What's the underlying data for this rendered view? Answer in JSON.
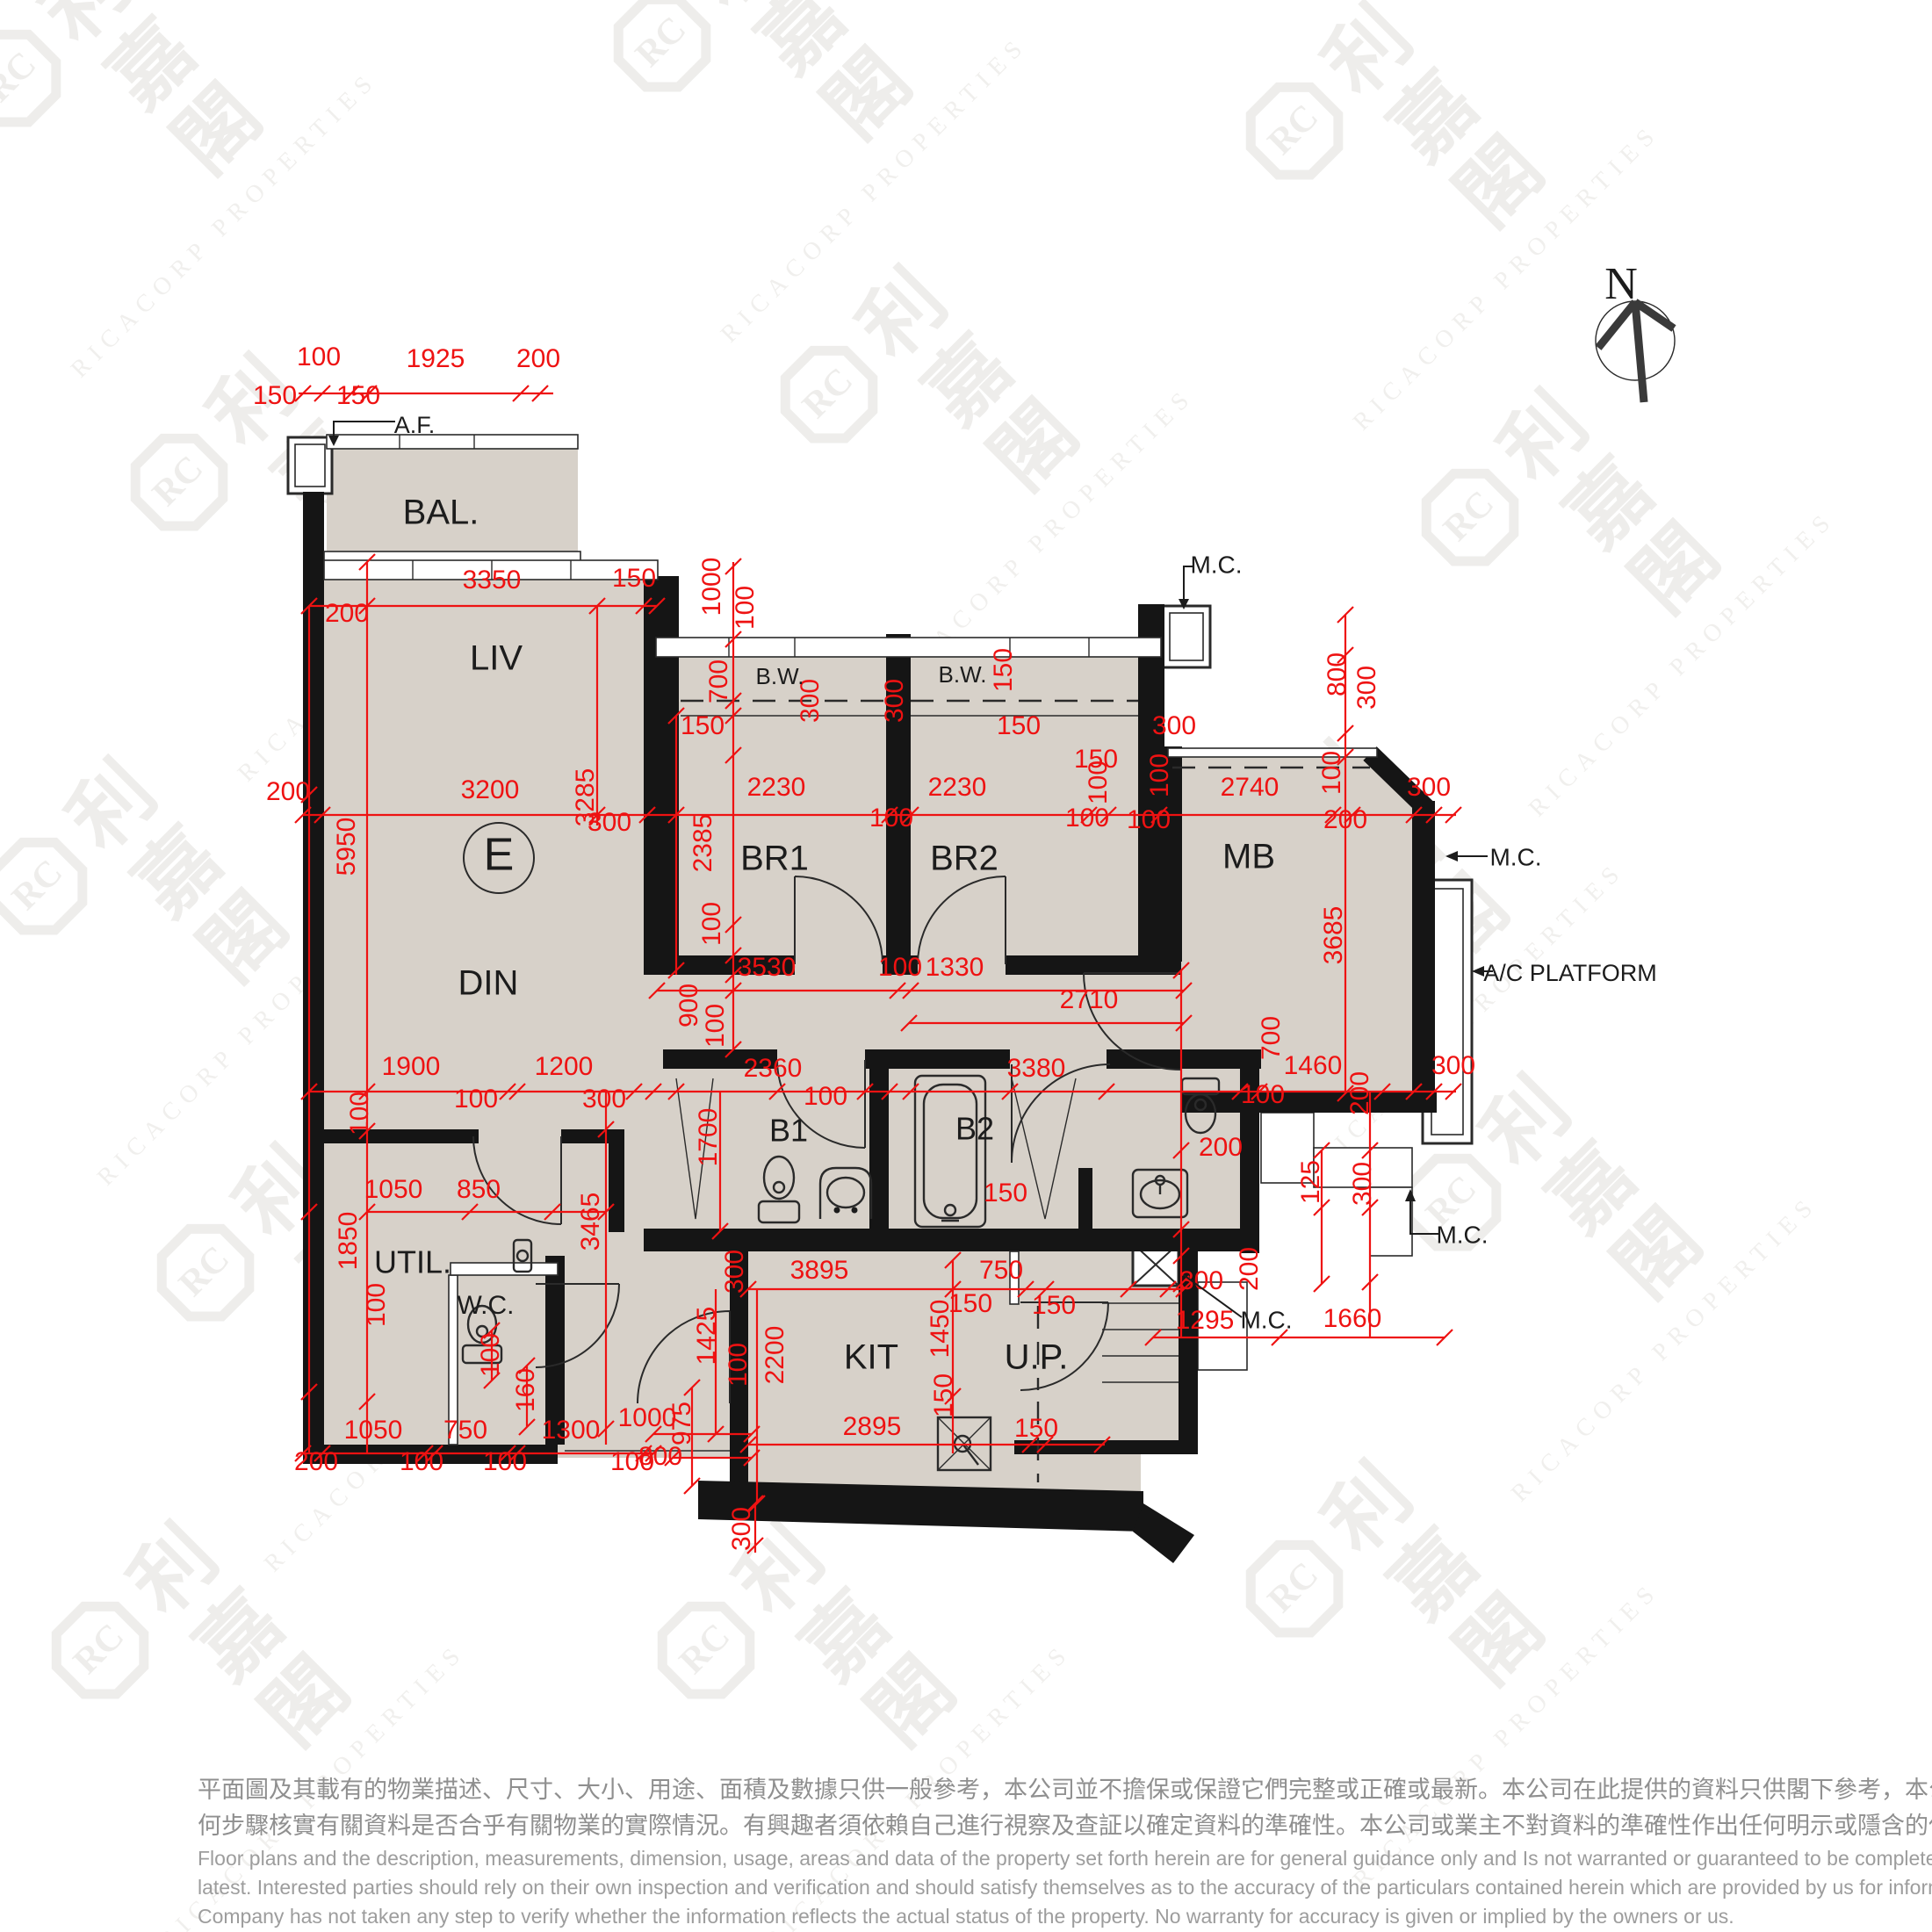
{
  "colors": {
    "floor": "#d7d1c9",
    "wall": "#151515",
    "dimension_red": "#ee1212",
    "watermark_gray": "#dedcd8",
    "disclaimer_gray": "#8f8f8f"
  },
  "north": {
    "label": "N"
  },
  "watermark": {
    "cjk": "利嘉閣",
    "latin": "RICACORP PROPERTIES",
    "logo": "RC",
    "tiles": [
      [
        140,
        140
      ],
      [
        880,
        100
      ],
      [
        1600,
        200
      ],
      [
        330,
        600
      ],
      [
        1070,
        500
      ],
      [
        1800,
        640
      ],
      [
        170,
        1060
      ],
      [
        900,
        960
      ],
      [
        1560,
        1040
      ],
      [
        360,
        1500
      ],
      [
        1080,
        1440
      ],
      [
        1780,
        1420
      ],
      [
        240,
        1930
      ],
      [
        930,
        1930
      ],
      [
        1600,
        1860
      ]
    ]
  },
  "rooms": [
    [
      "BAL.",
      502,
      586,
      40
    ],
    [
      "LIV",
      565,
      752,
      40
    ],
    [
      "DIN",
      556,
      1122,
      40
    ],
    [
      "E",
      568,
      977,
      52
    ],
    [
      "BR1",
      882,
      980,
      40
    ],
    [
      "BR2",
      1098,
      980,
      40
    ],
    [
      "MB",
      1422,
      978,
      40
    ],
    [
      "B1",
      898,
      1290,
      36
    ],
    [
      "B2",
      1110,
      1288,
      36
    ],
    [
      "UTIL.",
      470,
      1440,
      36
    ],
    [
      "W.C.",
      553,
      1488,
      30
    ],
    [
      "KIT",
      992,
      1548,
      40
    ],
    [
      "U.P.",
      1180,
      1548,
      40
    ]
  ],
  "annotations": [
    [
      "A.F.",
      472,
      486,
      27
    ],
    [
      "B.W.",
      888,
      772,
      26
    ],
    [
      "B.W.",
      1096,
      770,
      26
    ],
    [
      "M.C.",
      1385,
      645,
      28
    ],
    [
      "M.C.",
      1726,
      978,
      28
    ],
    [
      "M.C.",
      1665,
      1408,
      28
    ],
    [
      "M.C.",
      1442,
      1505,
      28
    ],
    [
      "A/C PLATFORM",
      1788,
      1110,
      27
    ]
  ],
  "dims": [
    [
      "100",
      363,
      408
    ],
    [
      "1925",
      496,
      410
    ],
    [
      "200",
      613,
      410
    ],
    [
      "150",
      313,
      452
    ],
    [
      "150",
      408,
      452
    ],
    [
      "3350",
      560,
      662
    ],
    [
      "150",
      722,
      660
    ],
    [
      "200",
      395,
      700
    ],
    [
      "1000",
      812,
      668,
      1
    ],
    [
      "100",
      850,
      692,
      1
    ],
    [
      "200",
      328,
      903
    ],
    [
      "3200",
      558,
      901
    ],
    [
      "3285",
      668,
      908,
      1
    ],
    [
      "300",
      694,
      938
    ],
    [
      "5950",
      396,
      964,
      1
    ],
    [
      "700",
      820,
      776,
      1
    ],
    [
      "300",
      924,
      798,
      1
    ],
    [
      "300",
      1020,
      798,
      1
    ],
    [
      "150",
      800,
      828
    ],
    [
      "150",
      1144,
      763,
      1
    ],
    [
      "150",
      1160,
      828
    ],
    [
      "150",
      1248,
      866
    ],
    [
      "300",
      1337,
      828
    ],
    [
      "2230",
      884,
      898
    ],
    [
      "2230",
      1090,
      898
    ],
    [
      "100",
      1015,
      933
    ],
    [
      "100",
      1238,
      933
    ],
    [
      "2385",
      802,
      960,
      1
    ],
    [
      "100",
      1252,
      891,
      1
    ],
    [
      "800",
      1524,
      768,
      1
    ],
    [
      "300",
      1558,
      783,
      1
    ],
    [
      "2740",
      1423,
      898
    ],
    [
      "100",
      1322,
      883,
      1
    ],
    [
      "100",
      1518,
      880,
      1
    ],
    [
      "100",
      1308,
      935
    ],
    [
      "200",
      1532,
      935
    ],
    [
      "300",
      1627,
      898
    ],
    [
      "3685",
      1520,
      1065,
      1
    ],
    [
      "100",
      812,
      1052,
      1
    ],
    [
      "3530",
      873,
      1103
    ],
    [
      "100",
      1025,
      1103
    ],
    [
      "1330",
      1087,
      1103
    ],
    [
      "900",
      786,
      1145,
      1
    ],
    [
      "100",
      816,
      1168,
      1
    ],
    [
      "2710",
      1240,
      1140
    ],
    [
      "1900",
      468,
      1216
    ],
    [
      "100",
      542,
      1253
    ],
    [
      "1200",
      642,
      1216
    ],
    [
      "300",
      688,
      1253
    ],
    [
      "100",
      411,
      1268,
      1
    ],
    [
      "2360",
      880,
      1218
    ],
    [
      "100",
      940,
      1250
    ],
    [
      "3380",
      1180,
      1218
    ],
    [
      "1700",
      808,
      1295,
      1
    ],
    [
      "150",
      1145,
      1360
    ],
    [
      "1460",
      1495,
      1215
    ],
    [
      "100",
      1438,
      1248
    ],
    [
      "300",
      1655,
      1215
    ],
    [
      "200",
      1550,
      1245,
      1
    ],
    [
      "700",
      1449,
      1182,
      1
    ],
    [
      "200",
      1390,
      1308
    ],
    [
      "125",
      1494,
      1346,
      1
    ],
    [
      "300",
      1553,
      1348,
      1
    ],
    [
      "200",
      1424,
      1445,
      1
    ],
    [
      "300",
      1368,
      1460
    ],
    [
      "1295",
      1372,
      1505
    ],
    [
      "1660",
      1540,
      1503
    ],
    [
      "1050",
      448,
      1356
    ],
    [
      "850",
      545,
      1356
    ],
    [
      "1850",
      398,
      1413,
      1
    ],
    [
      "100",
      430,
      1486,
      1
    ],
    [
      "3465",
      674,
      1391,
      1
    ],
    [
      "100",
      560,
      1543,
      1
    ],
    [
      "160",
      600,
      1583,
      1
    ],
    [
      "3895",
      933,
      1448
    ],
    [
      "300",
      838,
      1448,
      1
    ],
    [
      "750",
      1140,
      1448
    ],
    [
      "150",
      1105,
      1486
    ],
    [
      "150",
      1200,
      1488
    ],
    [
      "1450",
      1072,
      1513,
      1
    ],
    [
      "1425",
      806,
      1521,
      1
    ],
    [
      "100",
      842,
      1554,
      1
    ],
    [
      "2200",
      884,
      1543,
      1
    ],
    [
      "150",
      1076,
      1589,
      1
    ],
    [
      "2895",
      993,
      1626
    ],
    [
      "150",
      1180,
      1628
    ],
    [
      "975",
      778,
      1621,
      1
    ],
    [
      "300",
      846,
      1741,
      1
    ],
    [
      "200",
      360,
      1666
    ],
    [
      "1050",
      425,
      1630
    ],
    [
      "100",
      480,
      1666
    ],
    [
      "750",
      530,
      1630
    ],
    [
      "100",
      575,
      1666
    ],
    [
      "1300",
      650,
      1630
    ],
    [
      "100",
      720,
      1666
    ],
    [
      "1000",
      737,
      1616
    ],
    [
      "800",
      752,
      1660
    ]
  ],
  "layout": {
    "ticks": [
      [
        345,
        448
      ],
      [
        367,
        448
      ],
      [
        400,
        448
      ],
      [
        420,
        448
      ],
      [
        593,
        448
      ],
      [
        615,
        448
      ],
      [
        352,
        690
      ],
      [
        418,
        690
      ],
      [
        680,
        690
      ],
      [
        733,
        690
      ],
      [
        748,
        690
      ],
      [
        345,
        928
      ],
      [
        367,
        928
      ],
      [
        680,
        928
      ],
      [
        737,
        928
      ],
      [
        770,
        928
      ],
      [
        1013,
        928
      ],
      [
        1037,
        928
      ],
      [
        1240,
        928
      ],
      [
        1262,
        928
      ],
      [
        1320,
        928
      ],
      [
        1518,
        928
      ],
      [
        1540,
        928
      ],
      [
        1610,
        928
      ],
      [
        1633,
        928
      ],
      [
        1655,
        928
      ],
      [
        748,
        1128
      ],
      [
        835,
        1128
      ],
      [
        1022,
        1128
      ],
      [
        1037,
        1128
      ],
      [
        1348,
        1128
      ],
      [
        1035,
        1165
      ],
      [
        1348,
        1165
      ],
      [
        352,
        1243
      ],
      [
        418,
        1243
      ],
      [
        578,
        1243
      ],
      [
        589,
        1243
      ],
      [
        722,
        1243
      ],
      [
        744,
        1243
      ],
      [
        770,
        1243
      ],
      [
        885,
        1243
      ],
      [
        985,
        1243
      ],
      [
        1013,
        1243
      ],
      [
        1037,
        1243
      ],
      [
        1150,
        1243
      ],
      [
        1260,
        1243
      ],
      [
        1412,
        1243
      ],
      [
        1434,
        1243
      ],
      [
        1574,
        1243
      ],
      [
        1610,
        1243
      ],
      [
        1633,
        1243
      ],
      [
        1655,
        1243
      ],
      [
        418,
        1380
      ],
      [
        535,
        1380
      ],
      [
        629,
        1380
      ],
      [
        690,
        1380
      ],
      [
        852,
        1468
      ],
      [
        1085,
        1468
      ],
      [
        1168,
        1468
      ],
      [
        1191,
        1468
      ],
      [
        1285,
        1468
      ],
      [
        1330,
        1468
      ],
      [
        1348,
        1468
      ],
      [
        1313,
        1523
      ],
      [
        1457,
        1523
      ],
      [
        1645,
        1523
      ],
      [
        852,
        1645
      ],
      [
        1173,
        1645
      ],
      [
        1190,
        1645
      ],
      [
        1255,
        1645
      ],
      [
        345,
        1655
      ],
      [
        367,
        1655
      ],
      [
        484,
        1655
      ],
      [
        495,
        1655
      ],
      [
        578,
        1655
      ],
      [
        589,
        1655
      ],
      [
        733,
        1655
      ],
      [
        744,
        1655
      ],
      [
        744,
        1633
      ],
      [
        856,
        1633
      ],
      [
        766,
        1660
      ],
      [
        856,
        1660
      ],
      [
        352,
        905
      ],
      [
        352,
        1380
      ],
      [
        352,
        1585
      ],
      [
        418,
        640
      ],
      [
        418,
        1288
      ],
      [
        418,
        1596
      ],
      [
        770,
        815
      ],
      [
        770,
        1105
      ],
      [
        835,
        645
      ],
      [
        835,
        728
      ],
      [
        835,
        798
      ],
      [
        835,
        815
      ],
      [
        835,
        860
      ],
      [
        835,
        1053
      ],
      [
        835,
        1088
      ],
      [
        835,
        1110
      ],
      [
        835,
        1195
      ],
      [
        1532,
        700
      ],
      [
        1532,
        746
      ],
      [
        1532,
        835
      ],
      [
        1532,
        862
      ],
      [
        1532,
        1245
      ],
      [
        690,
        1286
      ],
      [
        690,
        1627
      ],
      [
        820,
        1402
      ],
      [
        1085,
        1435
      ],
      [
        1085,
        1590
      ],
      [
        862,
        1712
      ],
      [
        815,
        1633
      ],
      [
        788,
        1580
      ],
      [
        788,
        1692
      ],
      [
        1505,
        1310
      ],
      [
        1505,
        1375
      ],
      [
        1505,
        1462
      ],
      [
        1560,
        1310
      ],
      [
        1560,
        1375
      ],
      [
        1560,
        1460
      ],
      [
        1345,
        1105
      ],
      [
        1345,
        1310
      ],
      [
        1345,
        1400
      ],
      [
        1345,
        1430
      ],
      [
        1345,
        1462
      ],
      [
        600,
        1555
      ],
      [
        600,
        1625
      ],
      [
        560,
        1515
      ],
      [
        560,
        1572
      ],
      [
        860,
        1712
      ],
      [
        860,
        1760
      ]
    ]
  },
  "disclaimer": {
    "zh": [
      "平面圖及其載有的物業描述、尺寸、大小、用途、面積及數據只供一般參考，本公司並不擔保或保證它們完整或正確或最新。本公司在此提供的資料只供閣下參考，本公司並無採取任",
      "何步驟核實有關資料是否合乎有關物業的實際情況。有興趣者須依賴自己進行視察及查証以確定資料的準確性。本公司或業主不對資料的準確性作出任何明示或隱含的保證。"
    ],
    "en": [
      "Floor plans and the description, measurements, dimension, usage, areas and data of the property set forth herein are for general guidance only and Is not warranted or guaranteed to be complete or correct or the",
      "latest.  Interested parties should rely on their own inspection and verification and should satisfy themselves as to the accuracy of the particulars contained herein which are provided by us for information only.  Our",
      "Company has not taken any step to verify whether the information reflects the actual status of the property.  No warranty for accuracy is given or implied by the owners or us."
    ]
  }
}
